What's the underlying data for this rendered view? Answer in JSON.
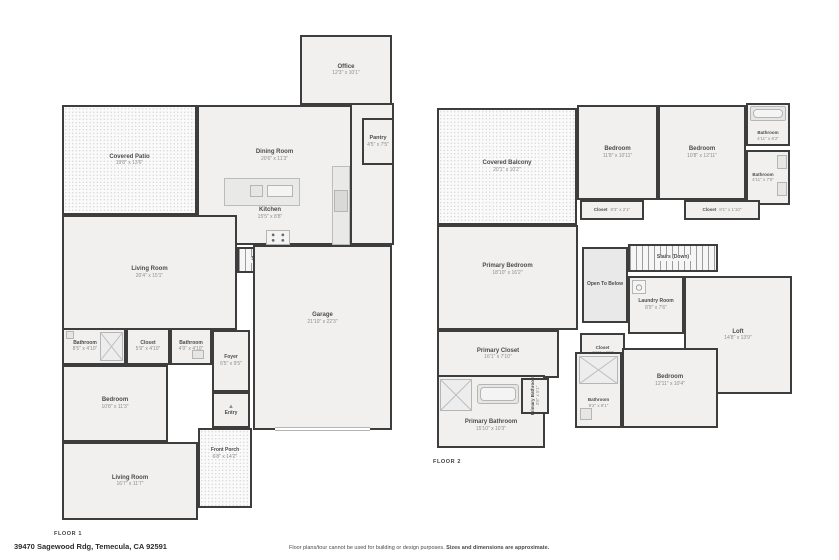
{
  "page": {
    "address": "39470 Sagewood Rdg, Temecula, CA 92591",
    "disclaimer_1": "Floor plans/tour cannot be used for building or design purposes.",
    "disclaimer_2": "Sizes and dimensions are approximate.",
    "floor1_label": "FLOOR 1",
    "floor2_label": "FLOOR 2"
  },
  "floor1": {
    "rooms": [
      {
        "name": "Office",
        "dims": "12'3\" x 10'1\""
      },
      {
        "name": "Pantry",
        "dims": "4'5\" x 7'5\""
      },
      {
        "name": "Covered Patio",
        "dims": "19'8\" x 13'6\""
      },
      {
        "name": "Dining Room",
        "dims": "20'6\" x 11'3\""
      },
      {
        "name": "Kitchen",
        "dims": "15'5\" x 8'8\""
      },
      {
        "name": "Stairs (Up)",
        "dims": ""
      },
      {
        "name": "Living Room",
        "dims": "20'4\" x 15'1\""
      },
      {
        "name": "Garage",
        "dims": "21'10\" x 22'3\""
      },
      {
        "name": "Bathroom",
        "dims": "8'5\" x 4'10\""
      },
      {
        "name": "Closet",
        "dims": "5'9\" x 4'10\""
      },
      {
        "name": "Bathroom",
        "dims": "4'9\" x 4'10\""
      },
      {
        "name": "Foyer",
        "dims": "6'5\" x 9'5\""
      },
      {
        "name": "Bedroom",
        "dims": "10'8\" x 11'3\""
      },
      {
        "name": "Entry",
        "dims": ""
      },
      {
        "name": "Front Porch",
        "dims": "6'8\" x 14'2\""
      },
      {
        "name": "Living Room",
        "dims": "16'7\" x 11'7\""
      }
    ]
  },
  "floor2": {
    "rooms": [
      {
        "name": "Covered Balcony",
        "dims": "20'1\" x 10'2\""
      },
      {
        "name": "Bedroom",
        "dims": "11'8\" x 10'11\""
      },
      {
        "name": "Bedroom",
        "dims": "10'8\" x 12'11\""
      },
      {
        "name": "Bathroom",
        "dims": "4'11\" x 6'2\""
      },
      {
        "name": "Bathroom",
        "dims": "4'11\" x 7'5\""
      },
      {
        "name": "Closet",
        "dims": "8'3\" x 2'1\""
      },
      {
        "name": "Closet",
        "dims": "8'1\" x 1'10\""
      },
      {
        "name": "Primary Bedroom",
        "dims": "18'10\" x 16'2\""
      },
      {
        "name": "Open To Below",
        "dims": ""
      },
      {
        "name": "Stairs (Down)",
        "dims": ""
      },
      {
        "name": "Laundry Room",
        "dims": "8'9\" x 7'6\""
      },
      {
        "name": "Loft",
        "dims": "14'8\" x 13'9\""
      },
      {
        "name": "Closet",
        "dims": "4'11\" x 5'8\""
      },
      {
        "name": "Primary Closet",
        "dims": "16'1\" x 7'10\""
      },
      {
        "name": "Primary Bathroom",
        "dims": "3'6\" x 5'1\""
      },
      {
        "name": "Primary Bathroom",
        "dims": "15'10\" x 10'3\""
      },
      {
        "name": "Bathroom",
        "dims": "9'2\" x 8'1\""
      },
      {
        "name": "Bedroom",
        "dims": "12'11\" x 10'4\""
      }
    ]
  }
}
